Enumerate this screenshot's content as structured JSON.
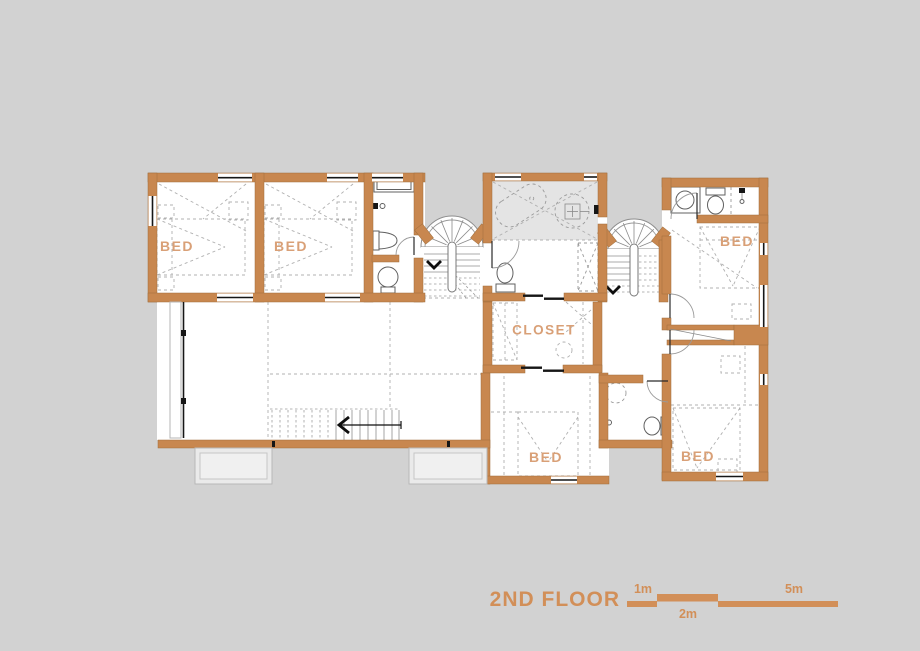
{
  "plan": {
    "title": "2ND FLOOR",
    "rooms": {
      "bed_top_left": "BED",
      "bed_top_middle": "BED",
      "bed_top_right": "BED",
      "bed_bottom_middle": "BED",
      "bed_bottom_right": "BED",
      "closet": "CLOSET"
    },
    "scale_bar": {
      "label_1m": "1m",
      "label_2m": "2m",
      "label_5m": "5m"
    },
    "colors": {
      "background": "#d2d2d2",
      "wall": "#c8874f",
      "accent_text": "#d28f58",
      "room_label": "#d9a077",
      "bath_fill": "#e4e4e4"
    }
  }
}
